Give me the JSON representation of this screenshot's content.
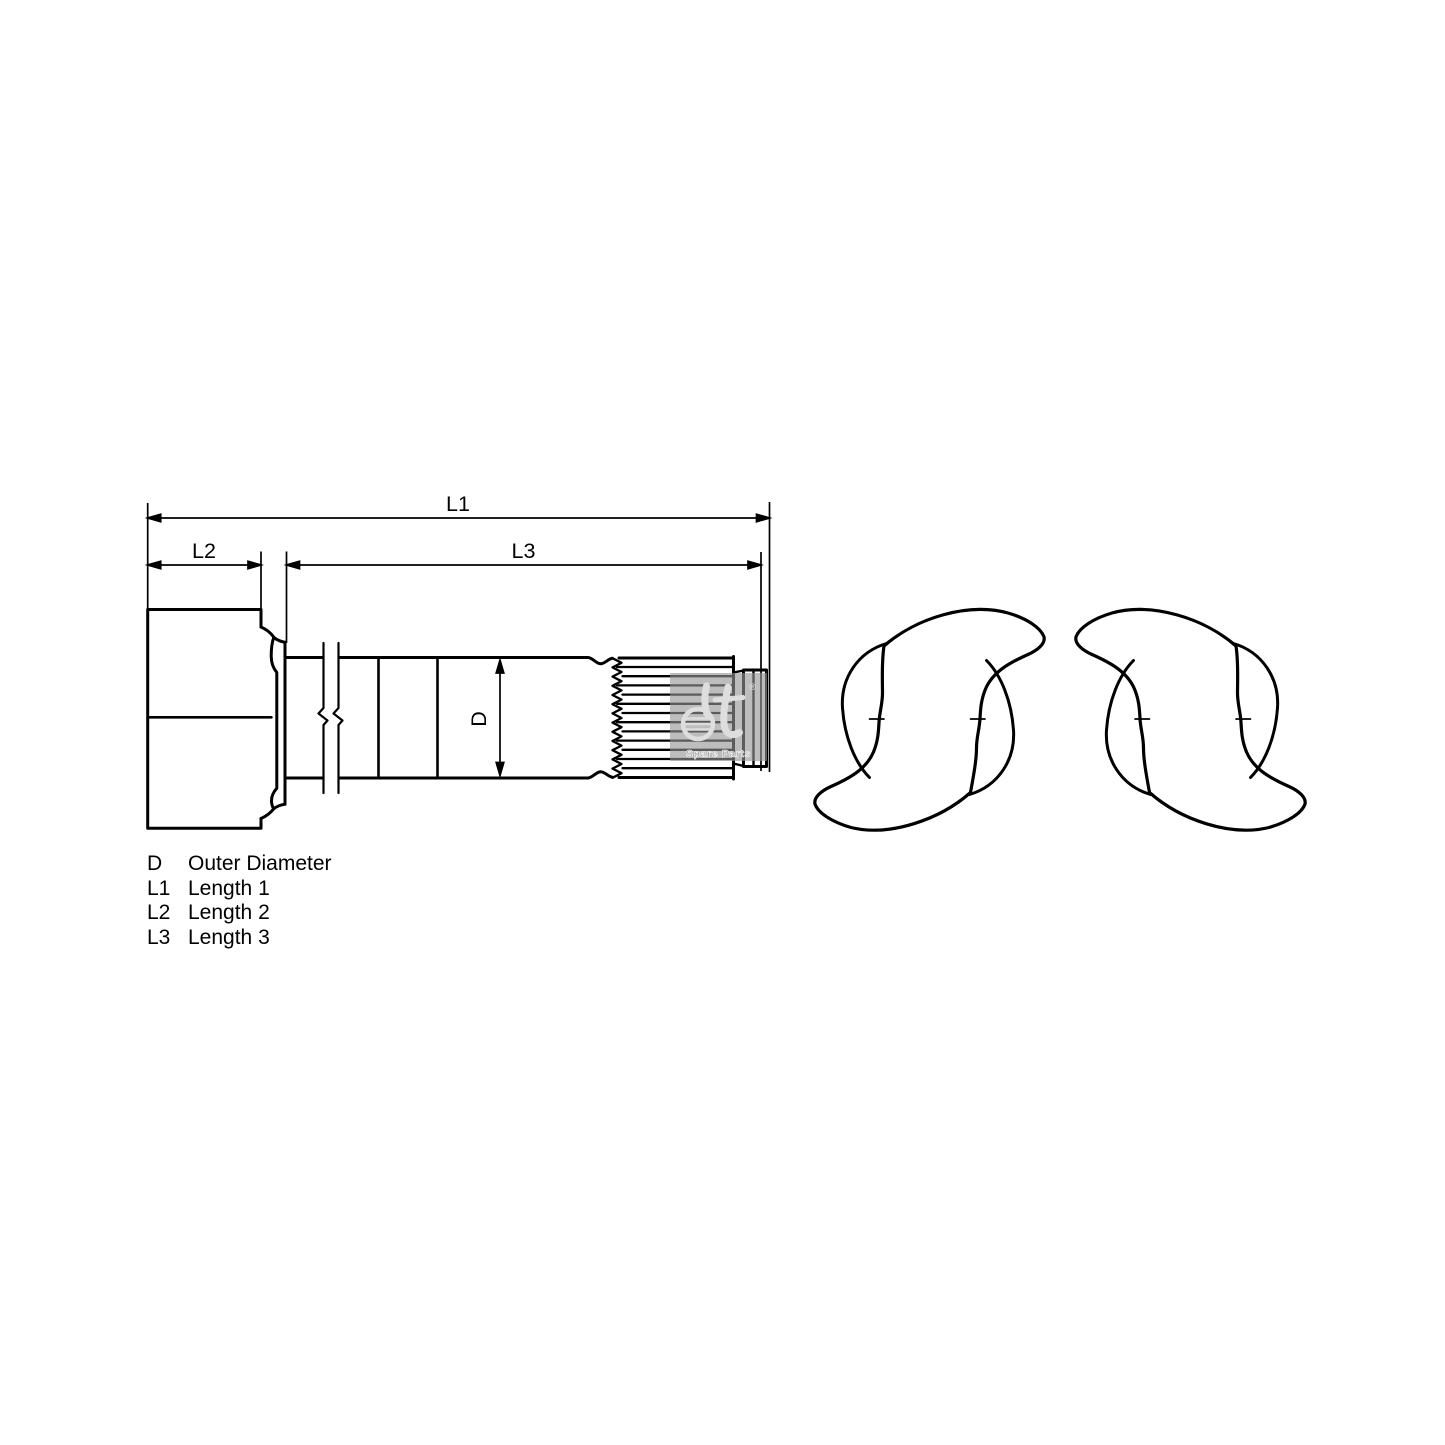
{
  "drawing": {
    "dimension_labels": {
      "overall_length": "L1",
      "head_length": "L2",
      "shaft_length": "L3",
      "diameter": "D"
    },
    "legend": {
      "items": [
        {
          "symbol": "D",
          "description": "Outer Diameter"
        },
        {
          "symbol": "L1",
          "description": "Length 1"
        },
        {
          "symbol": "L2",
          "description": "Length 2"
        },
        {
          "symbol": "L3",
          "description": "Length 3"
        }
      ]
    },
    "watermark": {
      "registered_mark": "®",
      "caption": "Spare Parts"
    },
    "colors": {
      "line": "#000000",
      "background": "#ffffff",
      "watermark_background": "rgba(148,148,148,0.62)",
      "watermark_caption": "#8f8f8f"
    }
  }
}
